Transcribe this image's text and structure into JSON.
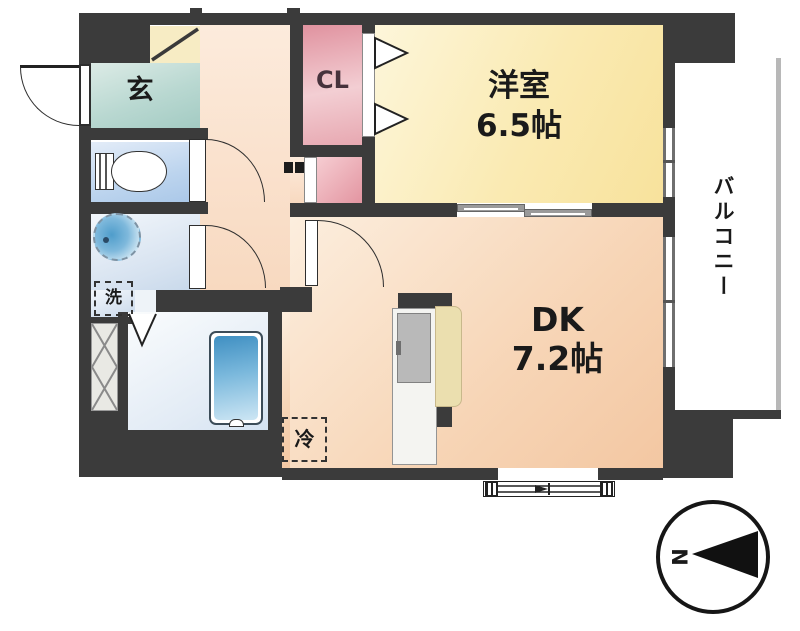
{
  "floorplan": {
    "type": "apartment-floor-plan-1DK",
    "rooms": {
      "genkan": {
        "label": "玄"
      },
      "closet": {
        "label": "CL"
      },
      "western_room": {
        "name": "洋室",
        "size": "6.5帖"
      },
      "dining_kitchen": {
        "name": "DK",
        "size": "7.2帖"
      },
      "balcony": {
        "label": "バルコニー"
      },
      "laundry_space": {
        "label": "洗"
      },
      "refrigerator_space": {
        "label": "冷"
      }
    },
    "compass": {
      "north_label": "N",
      "direction": "left"
    },
    "colors": {
      "wall": "#3b3b3b",
      "genkan": "#b9d8d1",
      "toilet": "#bcd4ee",
      "closet": "#e59aa6",
      "western_room": "#f9e7ab",
      "dining_kitchen": "#f6d3b3",
      "bathroom": "#e2ebf5",
      "bathtub": "#4e9ac8"
    }
  }
}
